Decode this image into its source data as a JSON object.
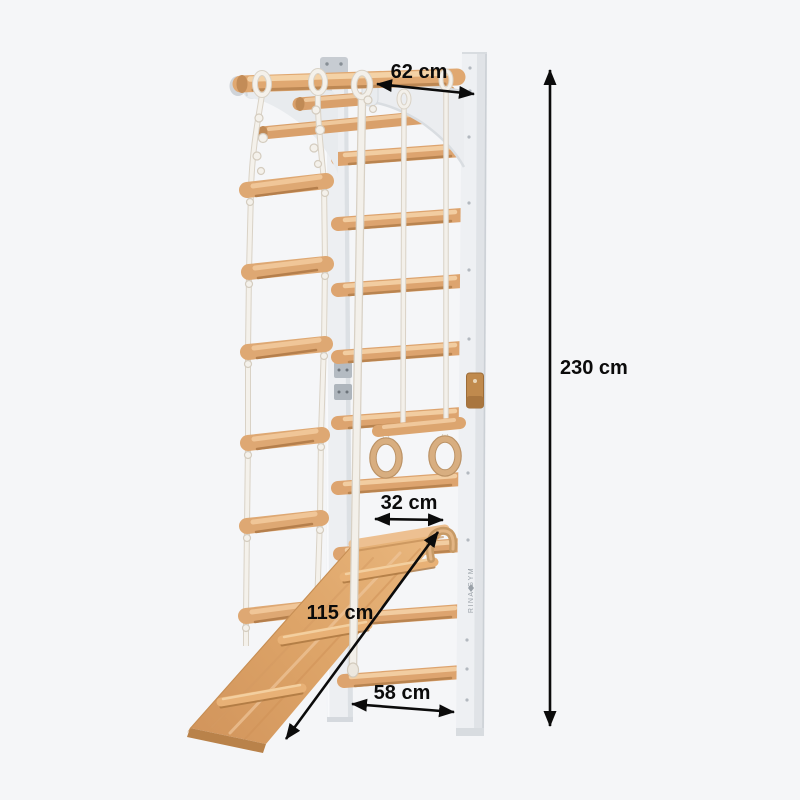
{
  "image_type": "product-dimension-illustration",
  "product": {
    "brand": "RINA GYM"
  },
  "dimensions": {
    "top_depth": "62 cm",
    "total_height": "230 cm",
    "ramp_width": "32 cm",
    "ramp_length": "115 cm",
    "base_width": "58 cm"
  },
  "icons": {
    "brand_logo": "small-diamond-mark"
  },
  "colors": {
    "background": "#f5f6f8",
    "frame_white": "#eef0f3",
    "frame_shadow": "#dce0e4",
    "wood_base": "#dda46f",
    "wood_highlight": "#f2cda1",
    "wood_shadow": "#b98450",
    "ramp_wood": "#e0a468",
    "rope": "#f3f0ea",
    "leather_strap": "#c08a4d",
    "metal": "#b4bbc2",
    "annotation": "#0b0b0b"
  }
}
